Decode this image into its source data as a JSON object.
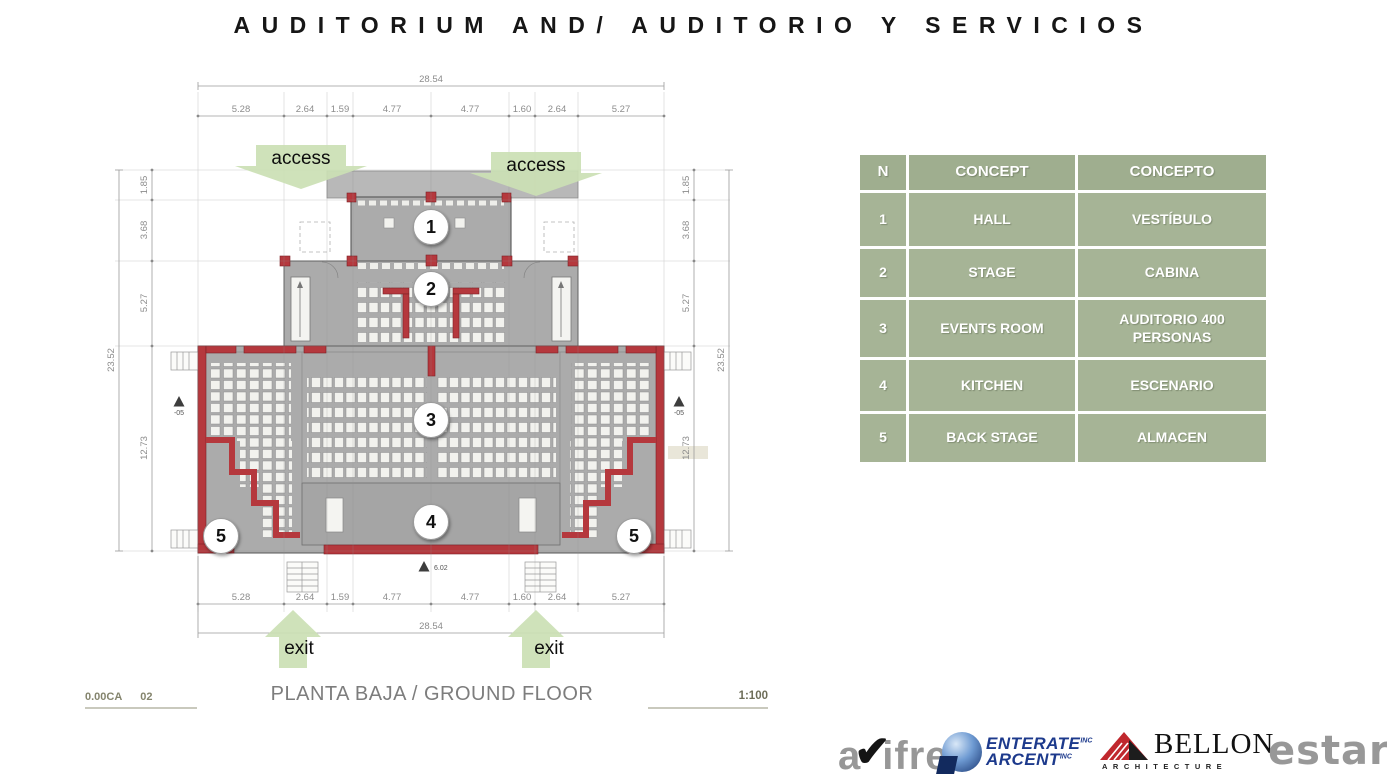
{
  "title": "AUDITORIUM AND/ AUDITORIO Y SERVICIOS",
  "plan": {
    "labels": {
      "access_left": "access",
      "access_right": "access",
      "exit_left": "exit",
      "exit_right": "exit"
    },
    "dims_top": {
      "total": "28.54",
      "segments": [
        "5.28",
        "2.64",
        "1.59",
        "4.77",
        "4.77",
        "1.60",
        "2.64",
        "5.27"
      ]
    },
    "dims_bottom": {
      "total": "28.54",
      "segments": [
        "5.28",
        "2.64",
        "1.59",
        "4.77",
        "4.77",
        "1.60",
        "2.64",
        "5.27"
      ]
    },
    "dims_left": {
      "total": "23.52",
      "segments": [
        "1.85",
        "3.68",
        "5.27",
        "12.73"
      ]
    },
    "dims_right": {
      "total": "23.52",
      "segments": [
        "1.85",
        "3.68",
        "5.27",
        "12.73"
      ]
    },
    "room_markers": [
      {
        "label": "1"
      },
      {
        "label": "2"
      },
      {
        "label": "3"
      },
      {
        "label": "4"
      },
      {
        "label": "5"
      },
      {
        "label": "5"
      }
    ],
    "level_markers": {
      "left": "-05",
      "right": "-05",
      "bottom": "6.02"
    },
    "caption": "PLANTA BAJA / GROUND FLOOR",
    "sheet_code": "0.00CA",
    "sheet_number": "02",
    "scale": "1:100"
  },
  "legend_table": {
    "headers": [
      "N",
      "CONCEPT",
      "CONCEPTO"
    ],
    "rows": [
      [
        "1",
        "HALL",
        "VESTÍBULO"
      ],
      [
        "2",
        "STAGE",
        "CABINA"
      ],
      [
        "3",
        "EVENTS ROOM",
        "AUDITORIO 400 PERSONAS"
      ],
      [
        "4",
        "KITCHEN",
        "ESCENARIO"
      ],
      [
        "5",
        "BACK STAGE",
        "ALMACEN"
      ]
    ]
  },
  "logos": {
    "avifre": {
      "part1": "a",
      "check": "✔",
      "part2": "ifre"
    },
    "enterate": {
      "line1": "ENTERATE",
      "line1_sub": "INC",
      "line2": "ARCENT",
      "line2_sub": "INC"
    },
    "bellon": {
      "name": "BELLON",
      "subtitle": "ARCHITECTURE"
    },
    "estar": {
      "name": "estar"
    }
  },
  "colors": {
    "wall_red": "#b5383d",
    "plan_gray": "#ababab",
    "table_green": "#a6b496",
    "arrow_green": "#cbe0b4"
  }
}
